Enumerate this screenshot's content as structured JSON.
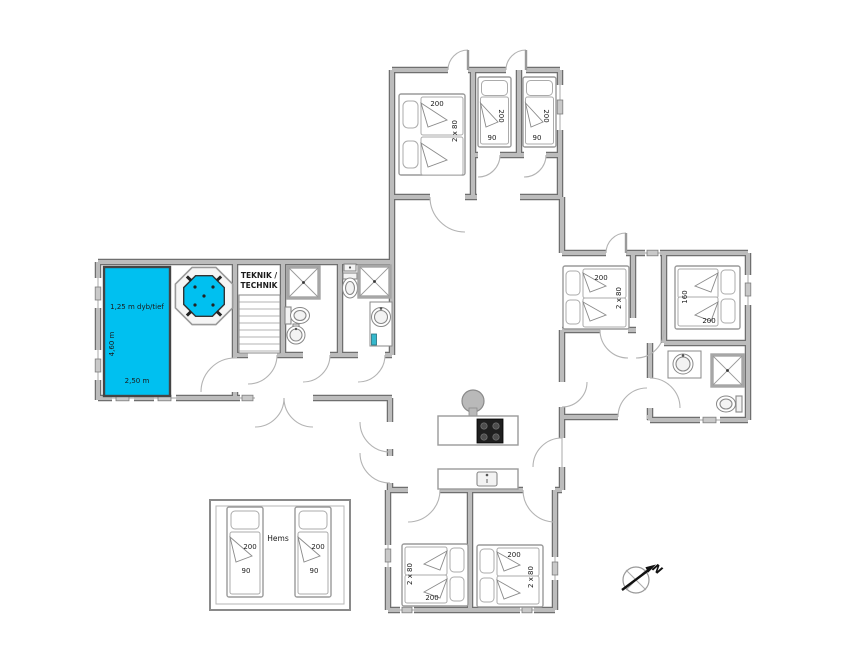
{
  "colors": {
    "pool_water": "#00c0f0",
    "walls": "#bcbcbc",
    "wall_outline": "#6f6f6f",
    "accent_teal": "#35b8cc"
  },
  "pool_area": {
    "pool_depth_label": "1,25 m dyb/tief",
    "pool_length_label": "4,60 m",
    "pool_width_label": "2,50 m"
  },
  "technical_room": {
    "label_line1": "TEKNIK /",
    "label_line2": "TECHNIK"
  },
  "bedrooms": {
    "north_double": {
      "bed_length": "200",
      "bed_width": "2 x 80"
    },
    "north_single_left": {
      "bed_length": "200",
      "bed_width": "90"
    },
    "north_single_right": {
      "bed_length": "200",
      "bed_width": "90"
    },
    "east_double": {
      "bed_length": "200",
      "bed_width": "2 x 80"
    },
    "east_master": {
      "bed_width": "160",
      "bed_length": "200"
    },
    "south_left": {
      "bed_width": "2 x 80",
      "bed_length": "200"
    },
    "south_right": {
      "bed_length": "200",
      "bed_width": "2 x 80"
    }
  },
  "hems": {
    "room_label": "Hems",
    "bed_left": {
      "length": "200",
      "width": "90"
    },
    "bed_right": {
      "length": "200",
      "width": "90"
    }
  },
  "compass": {
    "north": "N"
  }
}
